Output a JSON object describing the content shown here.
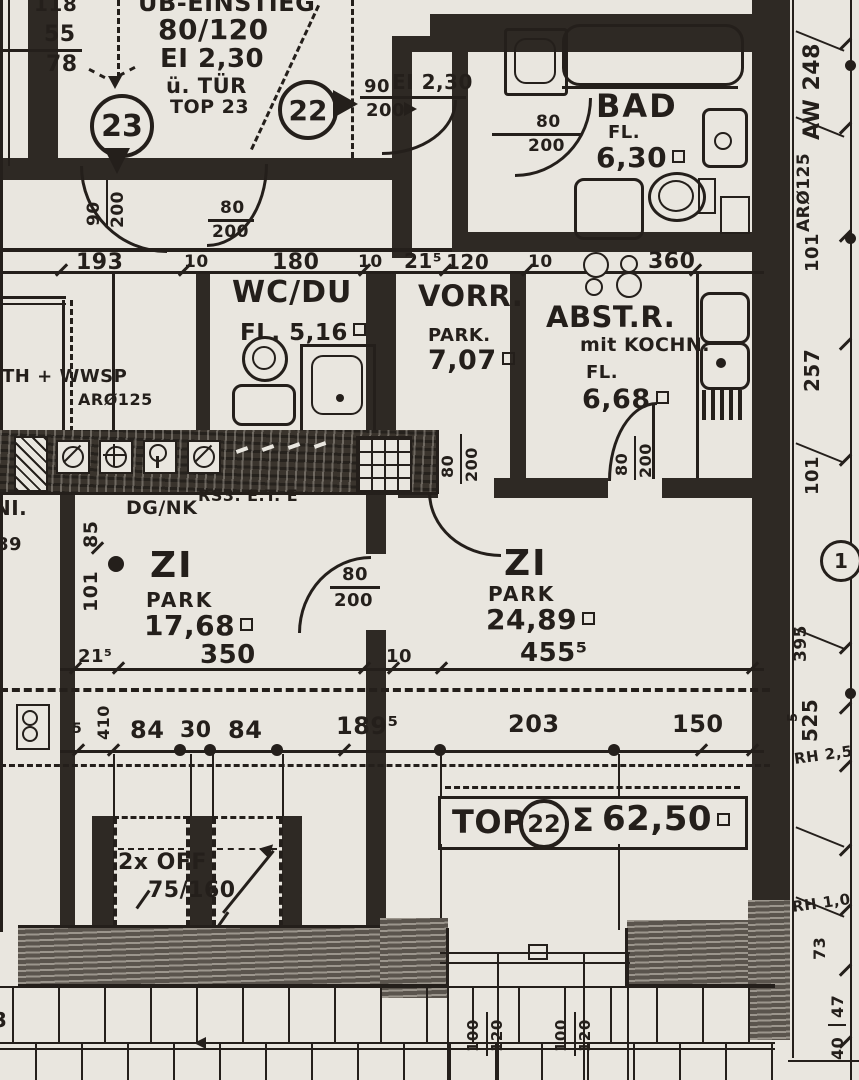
{
  "top_left": {
    "d118": "118",
    "d55": "55",
    "d78": "78"
  },
  "hatch_box": {
    "l1": "ÜB-EINSTIEG",
    "l2": "80/120",
    "l3": "EI 2,30",
    "l4": "ü. TÜR",
    "l5": "TOP 23"
  },
  "markers": {
    "c23": "23",
    "c22": "22",
    "c1": "1"
  },
  "entry": {
    "w": "90",
    "ei": "EI 2,30",
    "h": "200"
  },
  "rooms": {
    "bad": {
      "name": "BAD",
      "fl": "FL.",
      "area": "6,30"
    },
    "wcdu": {
      "name": "WC/DU",
      "fl": "FL. 5,16"
    },
    "vorr": {
      "name": "VORR.",
      "floor": "PARK.",
      "area": "7,07"
    },
    "abst": {
      "name": "ABST.R.",
      "sub": "mit KOCHN.",
      "fl": "FL.",
      "area": "6,68"
    },
    "zi1": {
      "name": "ZI",
      "floor": "PARK",
      "area": "17,68"
    },
    "zi2": {
      "name": "ZI",
      "floor": "PARK",
      "area": "24,89"
    }
  },
  "annot": {
    "th": "TH + WWSP",
    "ar": "ARØ125",
    "rs": "RS3. E.T. E",
    "dg": "DG/NK",
    "off": "2x OFF",
    "off_size": "75/160"
  },
  "doors": {
    "w80": "80",
    "w90": "90",
    "h200": "200"
  },
  "dims": {
    "mid": [
      "193",
      "10",
      "180",
      "10",
      "21⁵",
      "120",
      "10",
      "360"
    ],
    "zi": [
      "21⁵",
      "350",
      "10",
      "455⁵"
    ],
    "low": [
      "5",
      "410",
      "84",
      "30",
      "84",
      "189⁵",
      "203",
      "150"
    ],
    "vleft": [
      "85",
      "101"
    ],
    "parapet": [
      "100",
      "120",
      "100",
      "120"
    ]
  },
  "right_strip": {
    "labels": [
      "AW 248",
      "ARØ125",
      "101",
      "257",
      "101",
      "395",
      "525",
      "5",
      "73",
      "47",
      "40"
    ],
    "rh25": "RH 2,5",
    "rh10": "RH 1,0"
  },
  "summary": {
    "top": "TOP",
    "num": "22",
    "sigma": "Σ",
    "area": "62,50"
  },
  "fragments": {
    "ni": "NI.",
    "n89": "89",
    "f3": "3"
  }
}
